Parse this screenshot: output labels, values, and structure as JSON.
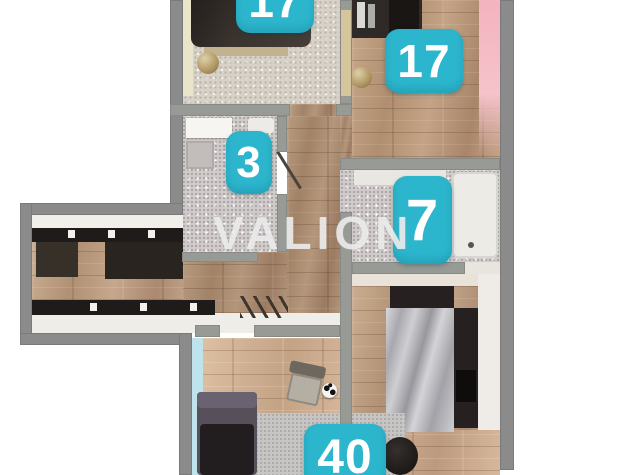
{
  "watermark": {
    "text": "VALION"
  },
  "badges": {
    "bedroom_top": {
      "label": "17"
    },
    "bedroom_right": {
      "label": "17"
    },
    "bathroom_small": {
      "label": "3"
    },
    "bathroom_large": {
      "label": "7"
    },
    "living": {
      "label": "40"
    }
  },
  "colors": {
    "badge_teal": "#2cb6cd",
    "wall_gray": "#8b8b8b",
    "inner_wall_gray": "#979a95",
    "accent_pink": "#f3b3bf",
    "accent_cyan": "#bfe3ec",
    "accent_yellow": "#e9e5cb",
    "wood_floor": "#bda083",
    "watermark_white": "#f0f0f0"
  }
}
